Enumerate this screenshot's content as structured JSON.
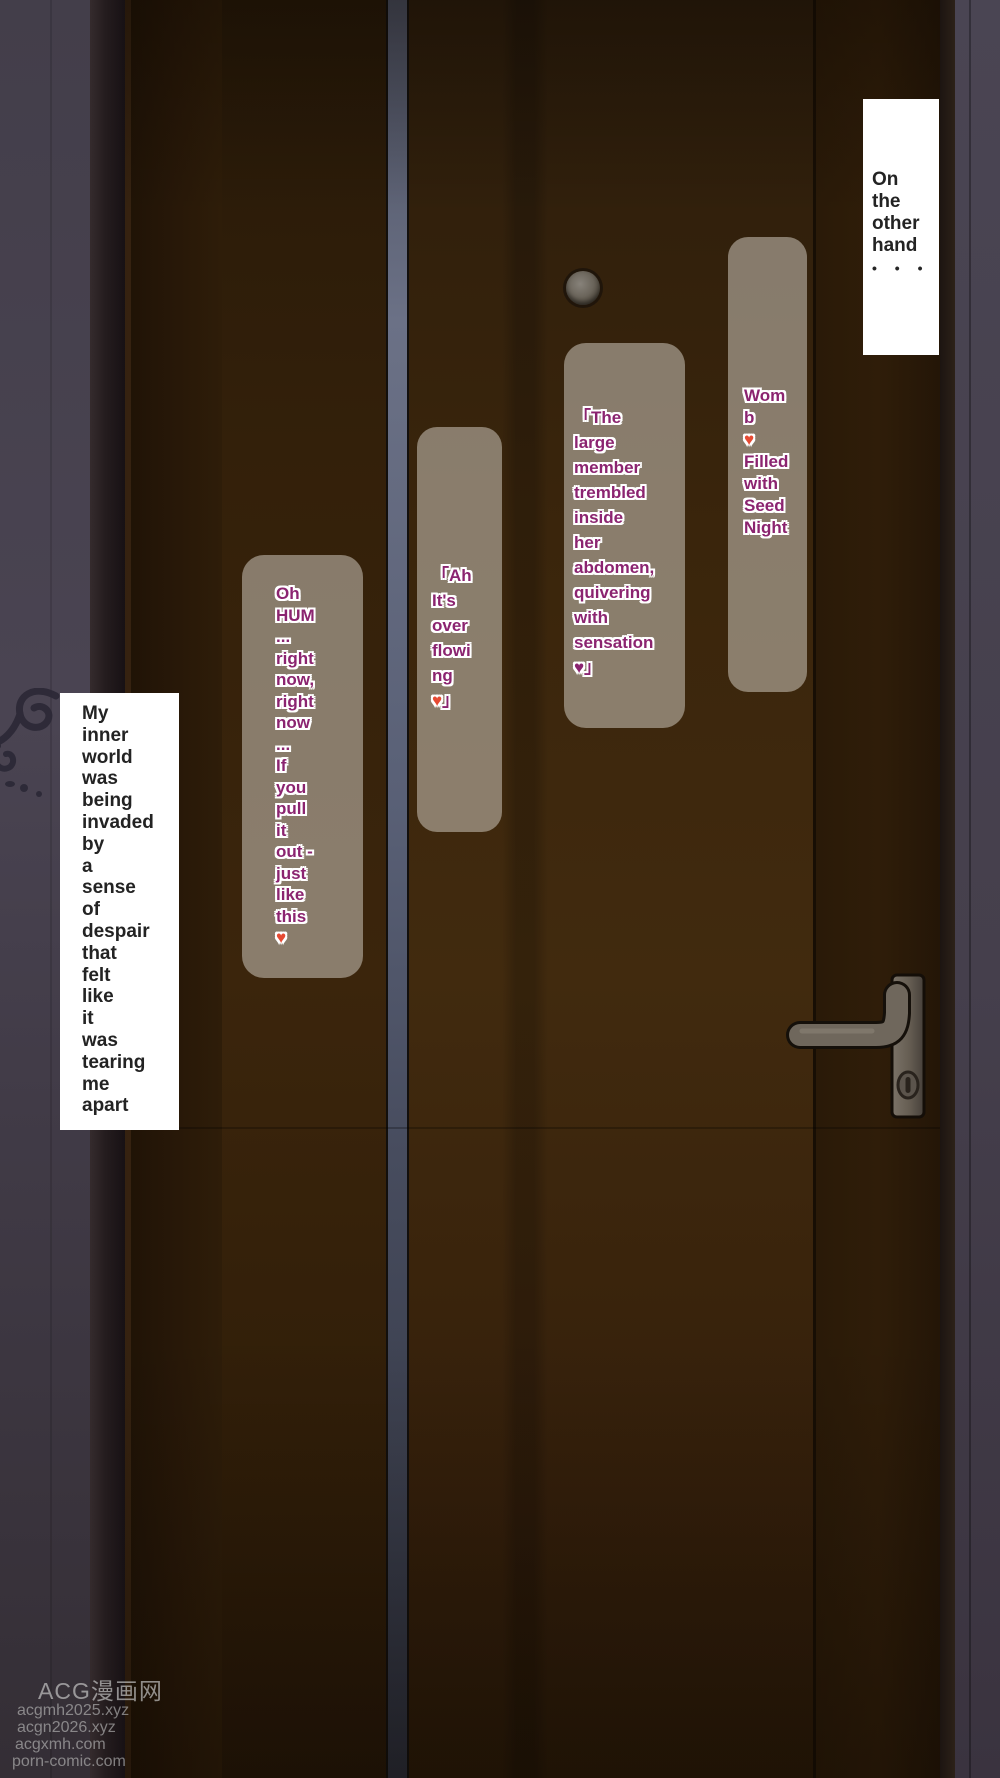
{
  "narration": {
    "top_right": {
      "text": "On\nthe\nother\nhand",
      "ellipsis": "• • •"
    },
    "left": {
      "text": "My\ninner\nworld\nwas\nbeing\ninvaded\nby\na\nsense\nof\ndespair\nthat\nfelt\nlike\nit\nwas\ntearing\nme\napart"
    }
  },
  "speech": {
    "womb": {
      "text_top": "Wom\nb",
      "heart": "♥",
      "text_bottom": "Filled\nwith\nSeed\nNight"
    },
    "member": {
      "text": "「The\nlarge\nmember\ntrembled\ninside\nher\nabdomen,\nquivering\nwith\nsensation",
      "heart": "♥",
      "closing_bracket": "」"
    },
    "overflow": {
      "text": "「Ah\nIt's\nover\nflowi\nng",
      "heart": "♥",
      "closing_bracket": "」"
    },
    "oh_hum": {
      "text": "Oh\nHUM\n...\nright\nnow,\nright\nnow\n...\nIf\nyou\npull\nit\nout -\njust\nlike\nthis",
      "heart": "♥"
    }
  },
  "watermark": {
    "brand": "ACG漫画网",
    "urls": [
      "acgmh2025.xyz",
      "acgn2026.xyz",
      "acgxmh.com",
      "porn-comic.com"
    ]
  },
  "colors": {
    "speech_text": "#8b2470",
    "heart_red": "#e64a33",
    "heart_purple": "#8b2470",
    "narration_text": "#232323",
    "speech_box_fill": "rgba(197,189,178,0.58)",
    "narration_box_fill": "#ffffff",
    "door_wood": "#3a2409",
    "door_gap_strip": "#5c6174",
    "wall": "#45404d",
    "watermark_text": "#b4b4b4"
  }
}
